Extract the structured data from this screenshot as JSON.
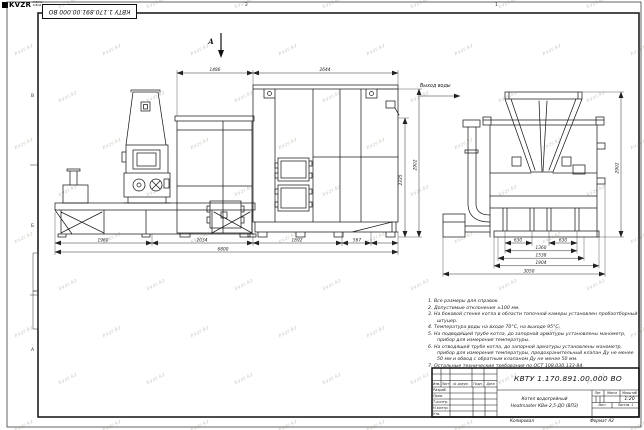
{
  "labels": {
    "section_view": "А",
    "water_outlet": "Выход воды"
  },
  "dims": {
    "top": [
      "1486",
      "2644"
    ],
    "height_outer": "2902",
    "height_inner": "2335",
    "bottom": [
      "1960",
      "2034",
      "1692",
      "567"
    ],
    "bottom_total": "6800",
    "side": [
      "630",
      "630",
      "1360",
      "1538",
      "1904",
      "3050"
    ],
    "side_height": "2902"
  },
  "notes": {
    "items": [
      "1. Все размеры для справок.",
      "2. Допустимые отклонения ±100 мм.",
      "3. На боковой стенке котла в области топочной камеры установлен пробоотборный штуцер.",
      "4. Температура воды на входе 70°С, на выходе 95°С.",
      "5. На подводящей трубе котла, до запорной арматуры установлены манометр, прибор для измерения температуры.",
      "6. На отводящей трубе котла, до запорной арматуры установлены манометр, прибор для измерения температуры, предохранительный клапан Ду не менее 50 мм и обвод с обратным клапаном Ду не менее 50 мм.",
      "7. Остальные технические требования по ОСТ 108.030.133-84."
    ]
  },
  "title_block": {
    "doc_number": "КВТУ 1.170.891.00.000 ВО",
    "product_name_1": "Котел водогрейный",
    "product_name_2": "Heatmaster КВм-2,5-ДО (ВП3)",
    "col_izm": "Изм.",
    "col_list": "Лист",
    "col_doc": "№ докум.",
    "col_sign": "Подп.",
    "col_date": "Дата",
    "row_developed": "Разраб.",
    "row_checked": "Пров.",
    "row_tcontrol": "Т.контр.",
    "row_ncontrol": "Н.контр.",
    "row_approved": "Утв.",
    "lit_label": "Лит.",
    "mass_label": "Масса",
    "scale_label": "Масштаб",
    "scale_value": "1:20",
    "sheet_label": "Лист",
    "sheets_label": "Листов",
    "sheets_value": "1",
    "logo_text": "KVZR",
    "logo_sub1": "КУБАНЬ",
    "logo_sub2": "ЗАВОД РФ",
    "copied_label": "Копировал",
    "format_label": "Формат А2"
  },
  "zones": {
    "top": [
      "2",
      "1"
    ],
    "left": [
      "В",
      "Б",
      "А"
    ]
  },
  "watermark": {
    "text": "kvzr.kz"
  }
}
